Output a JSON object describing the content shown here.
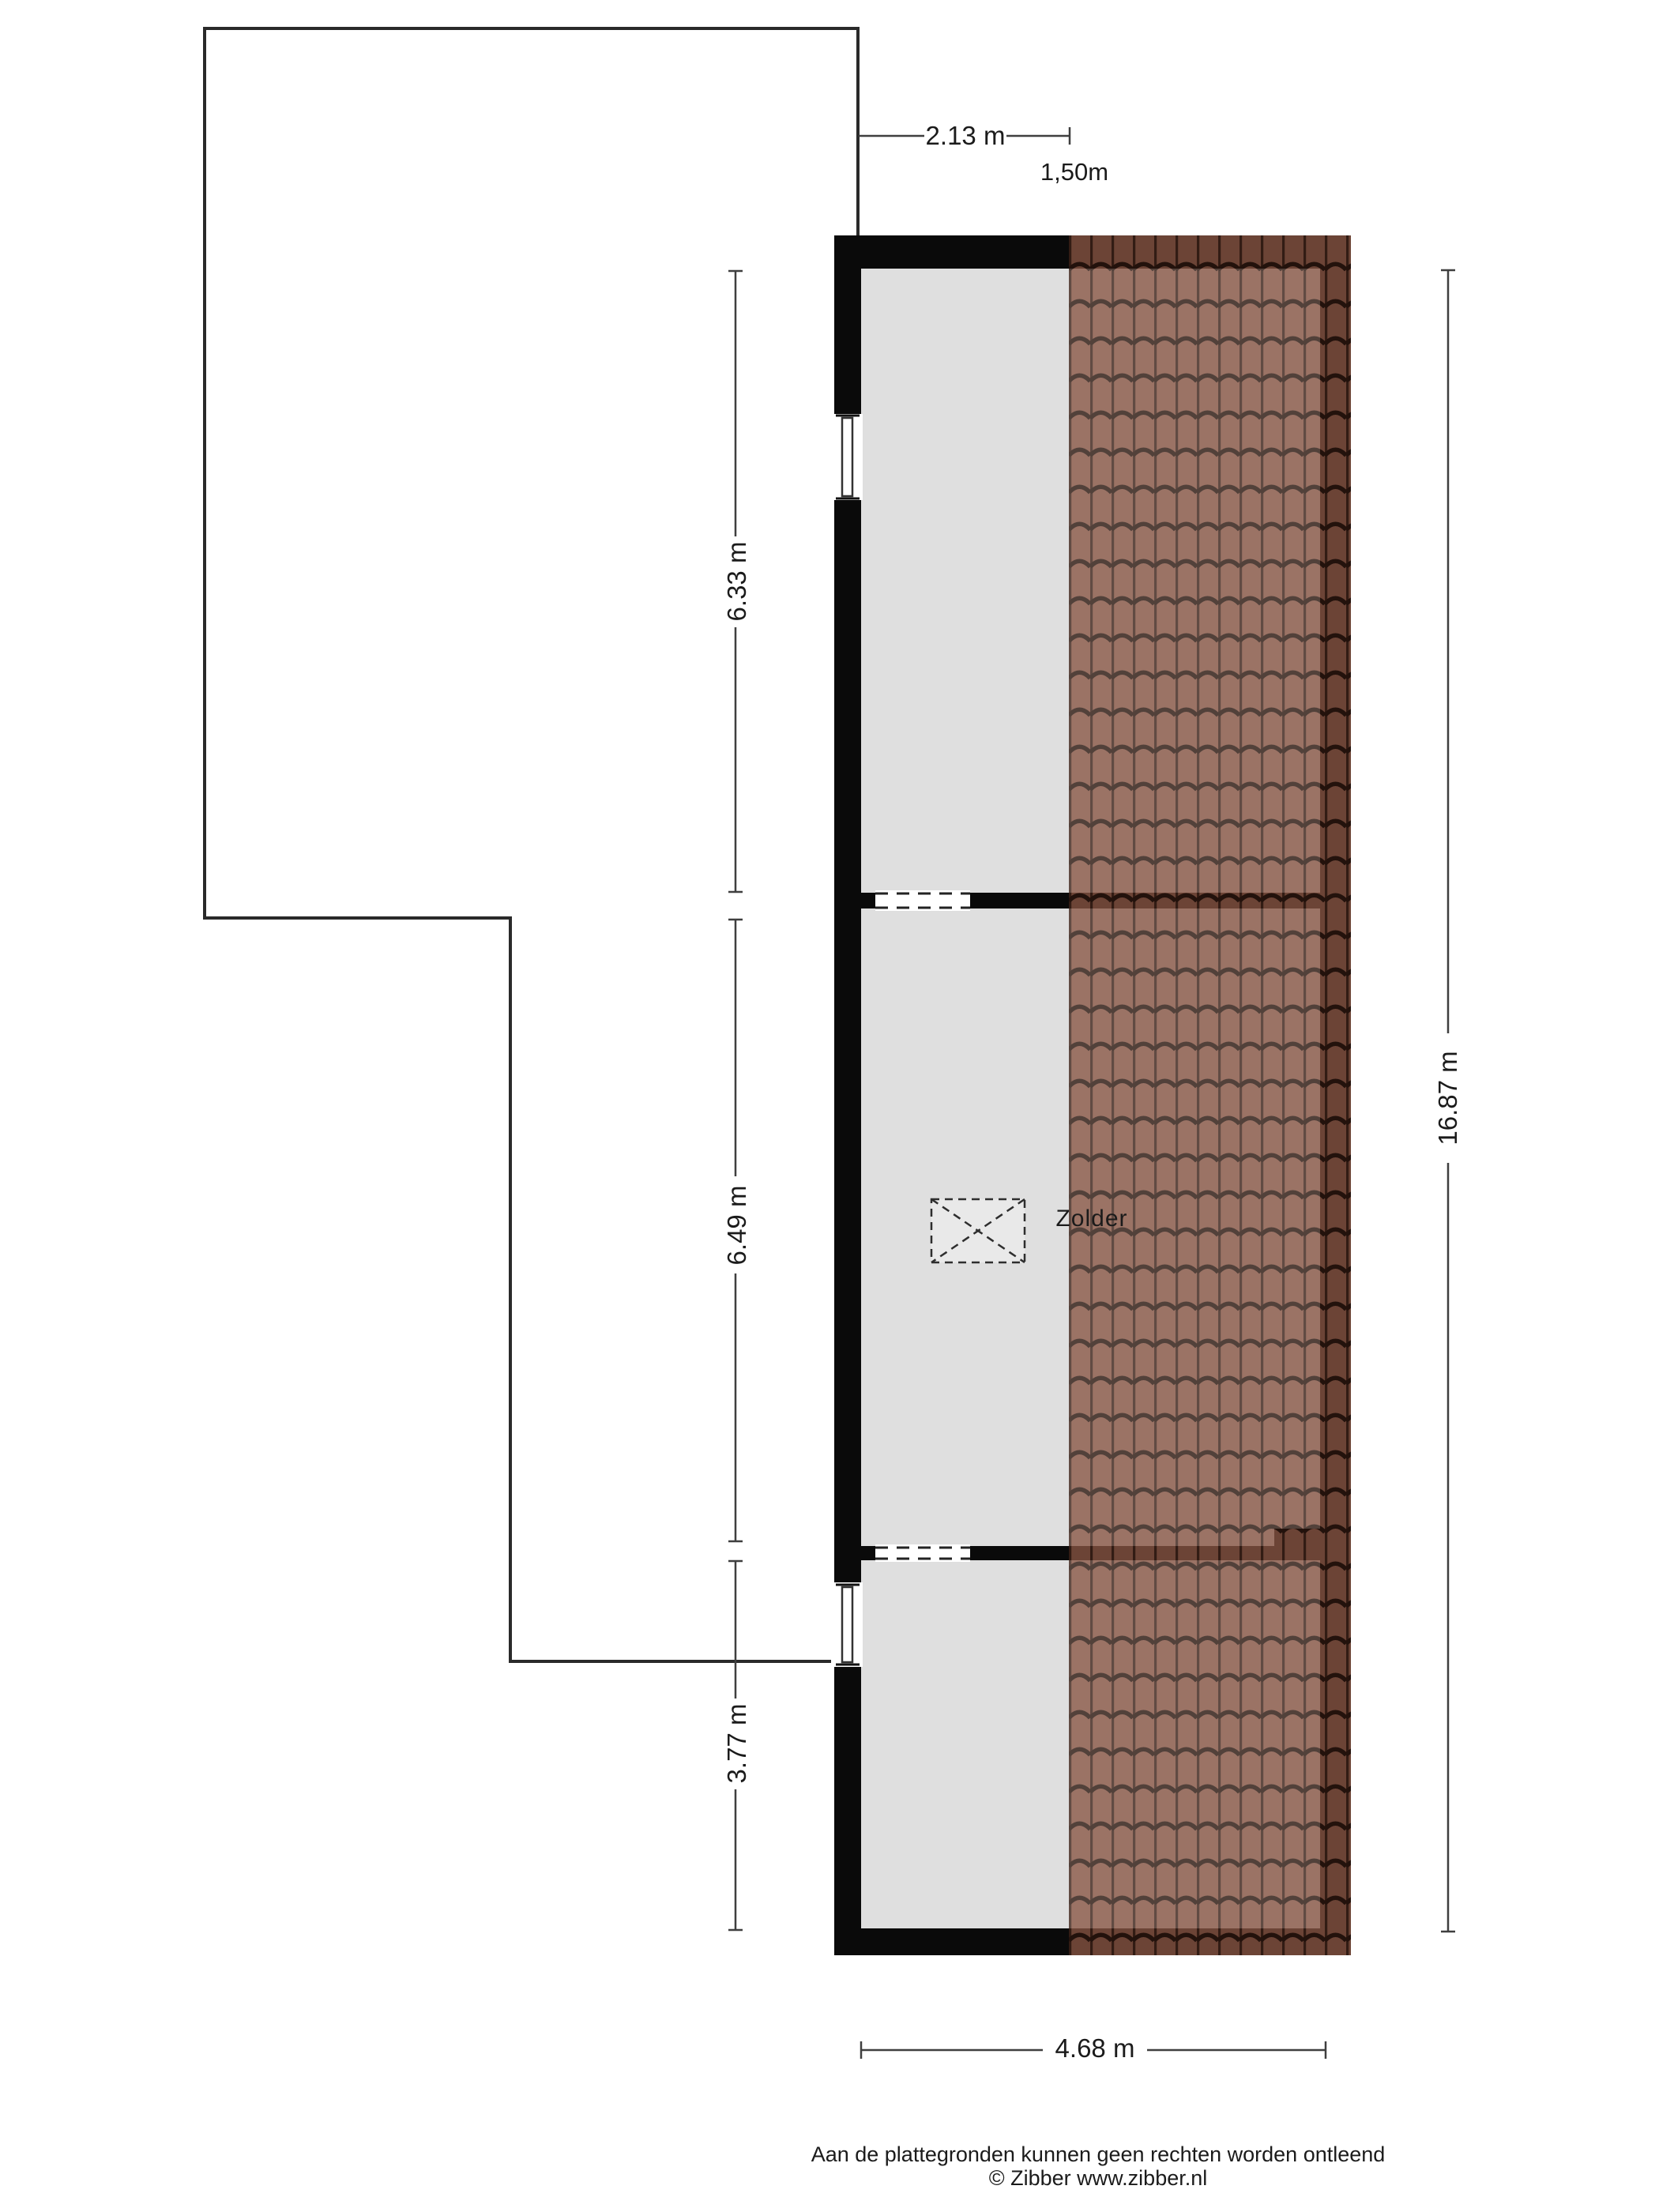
{
  "plan": {
    "room_label": "Zolder",
    "dim_top_width": "2.13 m",
    "dim_headroom": "1,50m",
    "dim_left_segments": [
      "6.33 m",
      "6.49 m",
      "3.77 m"
    ],
    "dim_right_total": "16.87 m",
    "dim_bottom_width": "4.68 m"
  },
  "footer": {
    "disclaimer": "Aan de plattegronden kunnen geen rechten worden ontleend",
    "credit": "© Zibber www.zibber.nl"
  },
  "colors": {
    "wall": "#0a0a0a",
    "floor": "#dfdfdf",
    "roof-base": "#885443",
    "roof-groove": "#2a140c",
    "outline": "#2a2a2a",
    "dim-line": "#3f3f3f",
    "text": "#1b1b1b"
  }
}
